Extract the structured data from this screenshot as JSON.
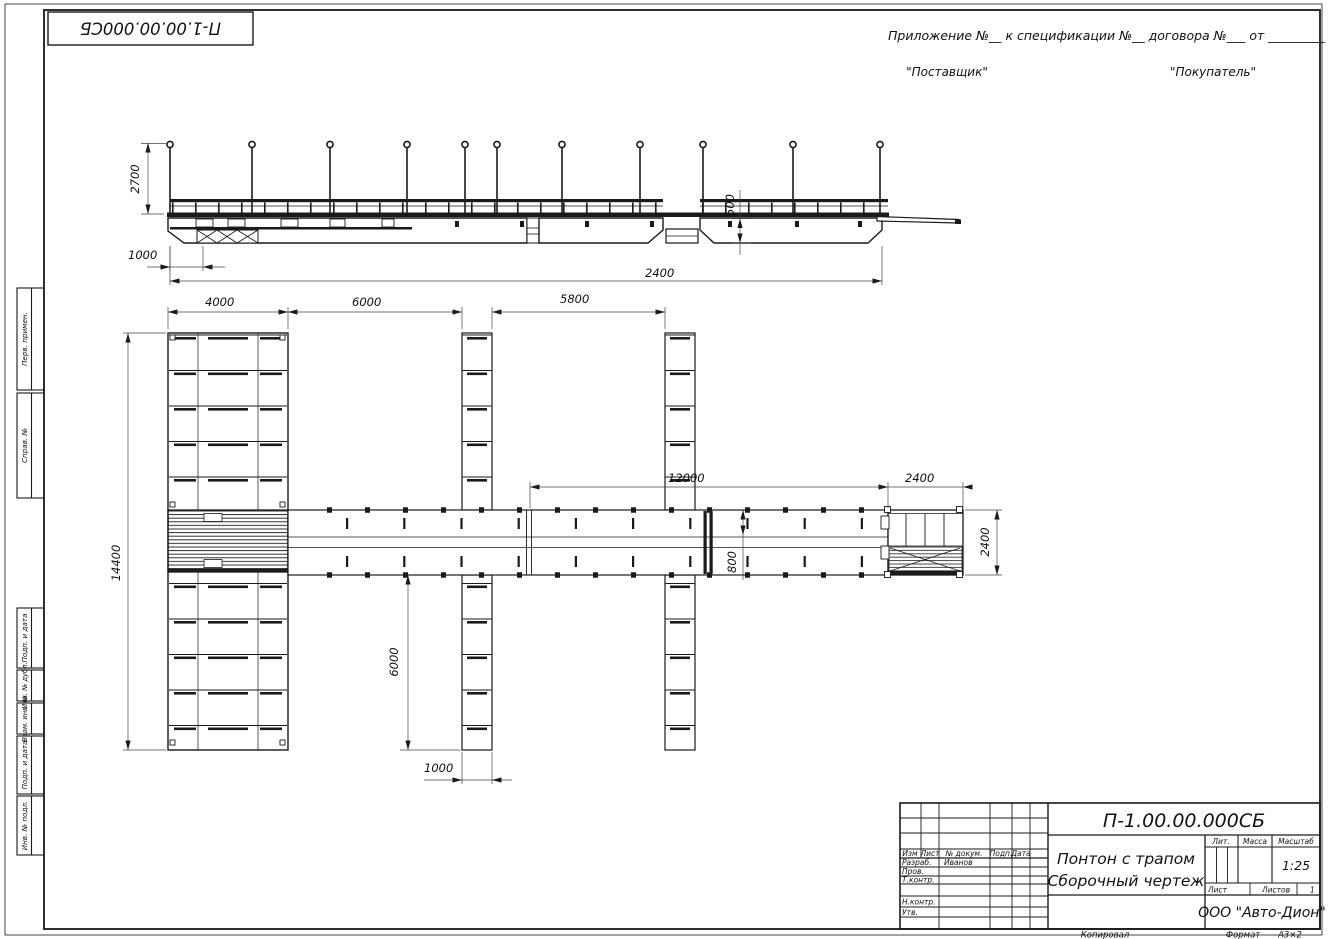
{
  "sheet": {
    "doc_number": "П-1.00.00.000СБ",
    "header": {
      "appendix_line": "Приложение №__      к спецификации №__    договора №___   от _________",
      "supplier": "\"Поставщик\"",
      "buyer": "\"Покупатель\""
    },
    "margin_labels": [
      "Перв. примен.",
      "Справ. №",
      "Подп. и дата",
      "Инв. № дубл.",
      "Взам. инв. №",
      "Подп. и дата",
      "Инв. № подл."
    ],
    "dims": {
      "e2700": "2700",
      "e1000": "1000",
      "e500": "500",
      "e2400": "2400",
      "p4000": "4000",
      "p6000": "6000",
      "p5800": "5800",
      "p12000": "12000",
      "p2400_top": "2400",
      "p14400": "14400",
      "p800": "800",
      "p2400_right": "2400",
      "p6000_bot": "6000",
      "p1000_bot": "1000"
    },
    "title_block": {
      "doc_number": "П-1.00.00.000СБ",
      "name_line1": "Понтон с трапом",
      "name_line2": "Сборочный чертеж",
      "col_izm": "Изм",
      "col_list": "Лист",
      "col_docnum": "№ докум.",
      "col_podp": "Подп.",
      "col_data": "Дата",
      "row_razrab": "Разраб.",
      "razrab_name": "Иванов",
      "row_prov": "Пров.",
      "row_tkontr": "Т.контр.",
      "row_nkontr": "Н.контр.",
      "row_utv": "Утв.",
      "lit": "Лит.",
      "massa": "Масса",
      "masshtab": "Масштаб",
      "scale": "1:25",
      "list": "Лист",
      "listov": "Листов",
      "listov_value": "1",
      "company": "ООО \"Авто-Дион\""
    },
    "footer": {
      "kopiroval": "Копировал",
      "format_label": "Формат",
      "format_value": "А3×2"
    }
  }
}
